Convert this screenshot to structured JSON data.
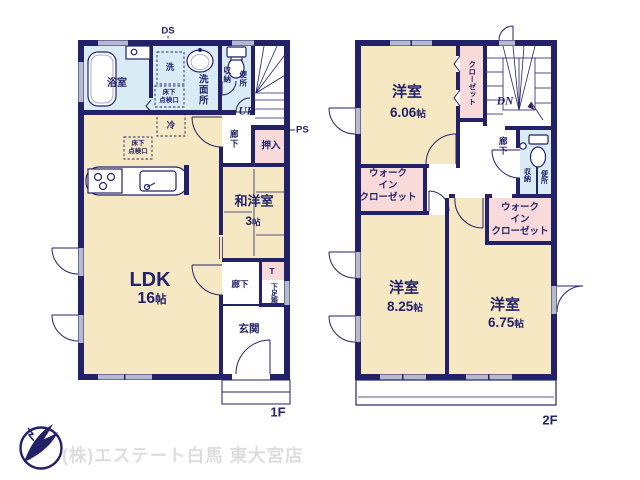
{
  "shared": {
    "size_unit": "帖"
  },
  "floor1": {
    "label": "1F",
    "bath": "浴室",
    "washroom": "洗面所",
    "laundry": "洗",
    "underfloor_l1": "床下",
    "underfloor_l2": "点検口",
    "fridge": "冷",
    "storage": "収納",
    "toilet": "便所",
    "stairs_up": "UP",
    "hallway_upper": "廊下",
    "oshiire": "押入",
    "pipe_space": "PS",
    "duct_space": "DS",
    "tatami_room": "和洋室",
    "tatami_size": "3",
    "ldk": "LDK",
    "ldk_size": "16",
    "hallway_lower": "廊下",
    "step": "T",
    "shoe_box": "下足箱",
    "entrance": "玄関"
  },
  "floor2": {
    "label": "2F",
    "bedroom": "洋室",
    "bedroom1_size": "6.06",
    "bedroom2_size": "8.25",
    "bedroom3_size": "6.75",
    "closet": "クローゼット",
    "stairs_down": "DN",
    "hallway": "廊下",
    "storage": "収納",
    "toilet": "便所",
    "wic_l1": "ウォーク",
    "wic_l2": "イン",
    "wic_l3": "クローゼット"
  },
  "footer": {
    "company": "(株)エステート白馬 東大宮店"
  },
  "colors": {
    "wall": "#232269",
    "room": "#f7e8c4",
    "wet": "#d9ecf6",
    "closet": "#f9dada",
    "window": "#b7bacf",
    "logo_text": "#dedede"
  }
}
